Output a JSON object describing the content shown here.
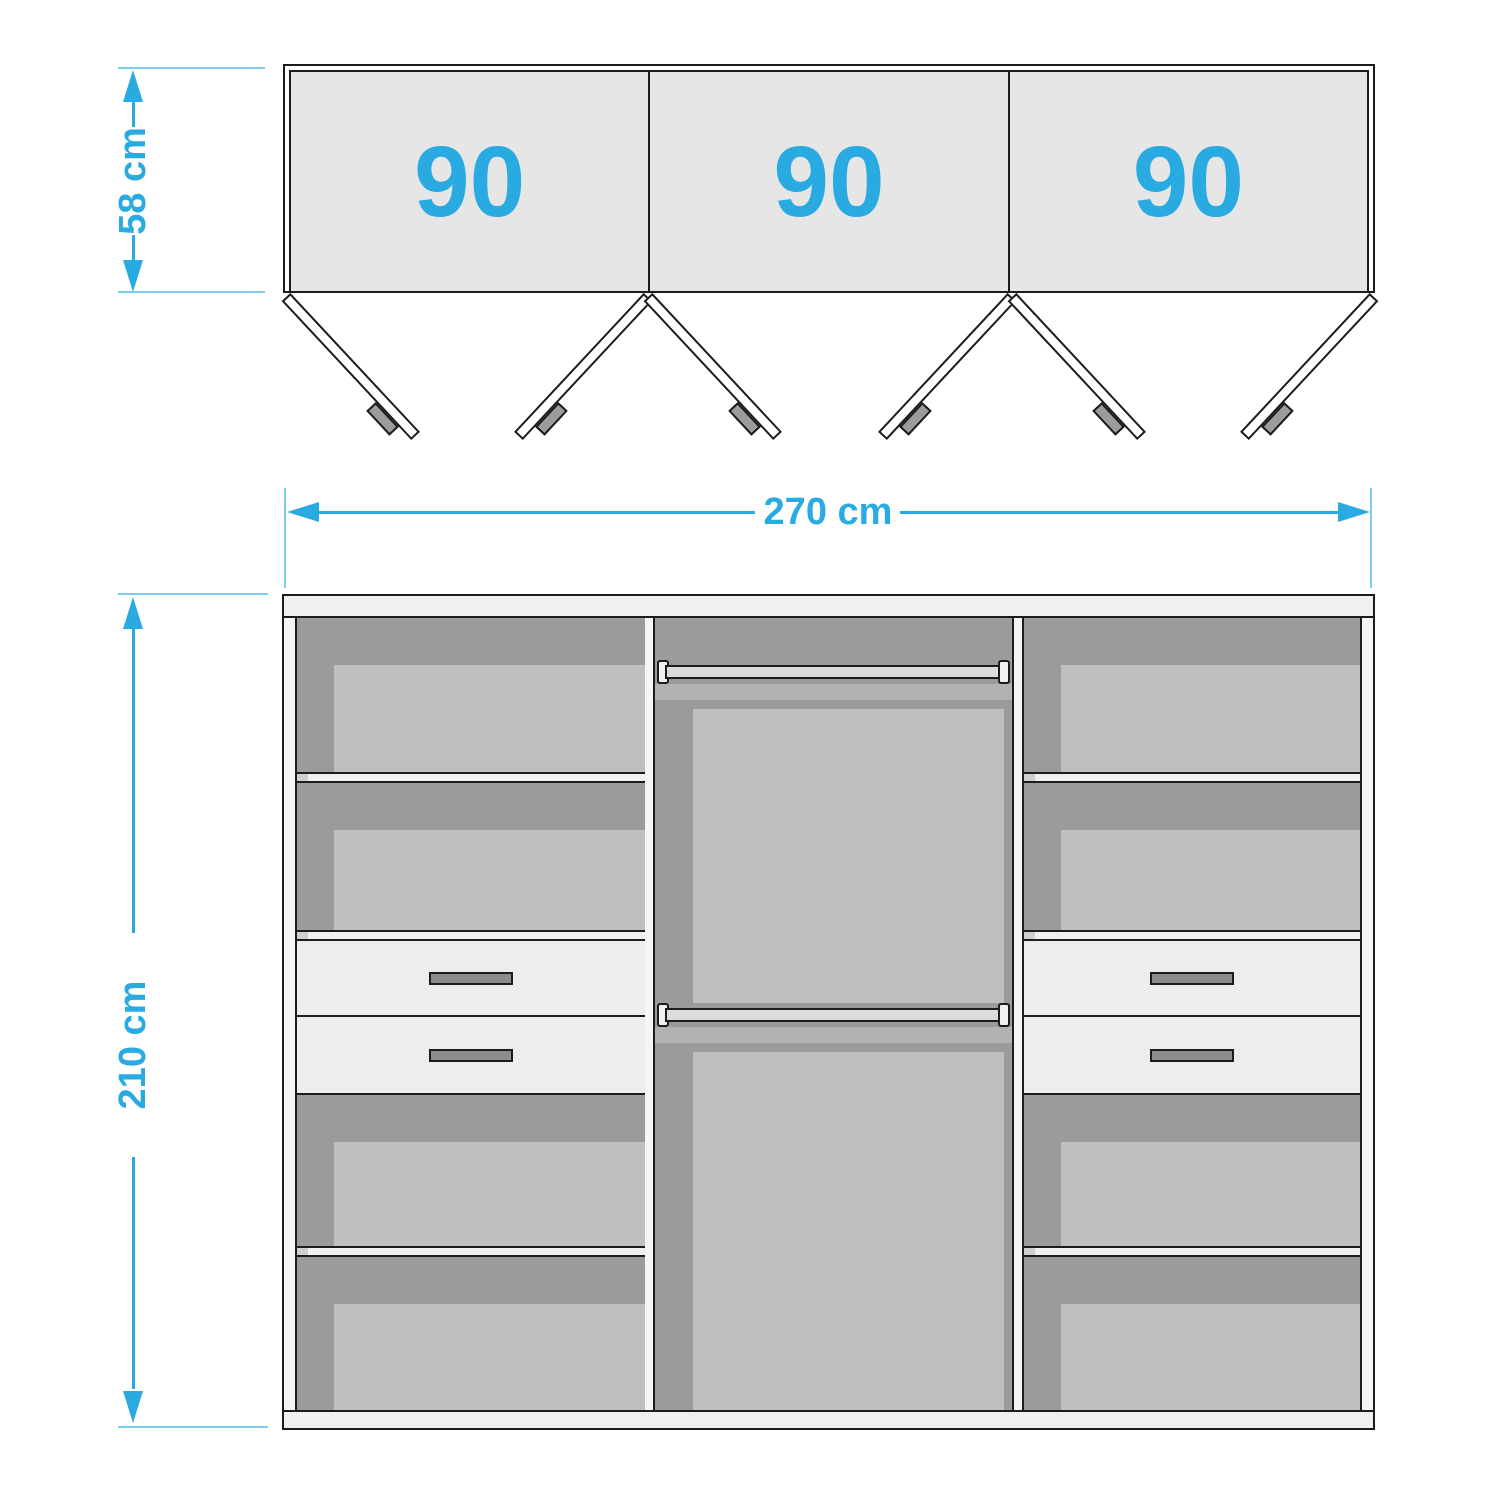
{
  "colors": {
    "accent": "#29abe2",
    "accent-light": "#7ccbee",
    "outline": "#1c1c1c",
    "panel-fill": "#e6e6e6",
    "comp-dark": "#9b9b9b",
    "comp-light": "#bfbfbf",
    "comp-band": "#b2b2b2",
    "board": "#f0f0f0",
    "wall": "#f5f5f5",
    "drawer": "#ededed",
    "handle": "#8c8c8c",
    "rod": "#dcdcdc",
    "support": "#cfcfcf",
    "door-fill": "#ffffff",
    "door-handle": "#9c9c9c"
  },
  "top_view": {
    "segments": [
      {
        "label": "90"
      },
      {
        "label": "90"
      },
      {
        "label": "90"
      }
    ]
  },
  "dimensions": {
    "depth": "58 cm",
    "width": "270 cm",
    "height": "210 cm"
  }
}
